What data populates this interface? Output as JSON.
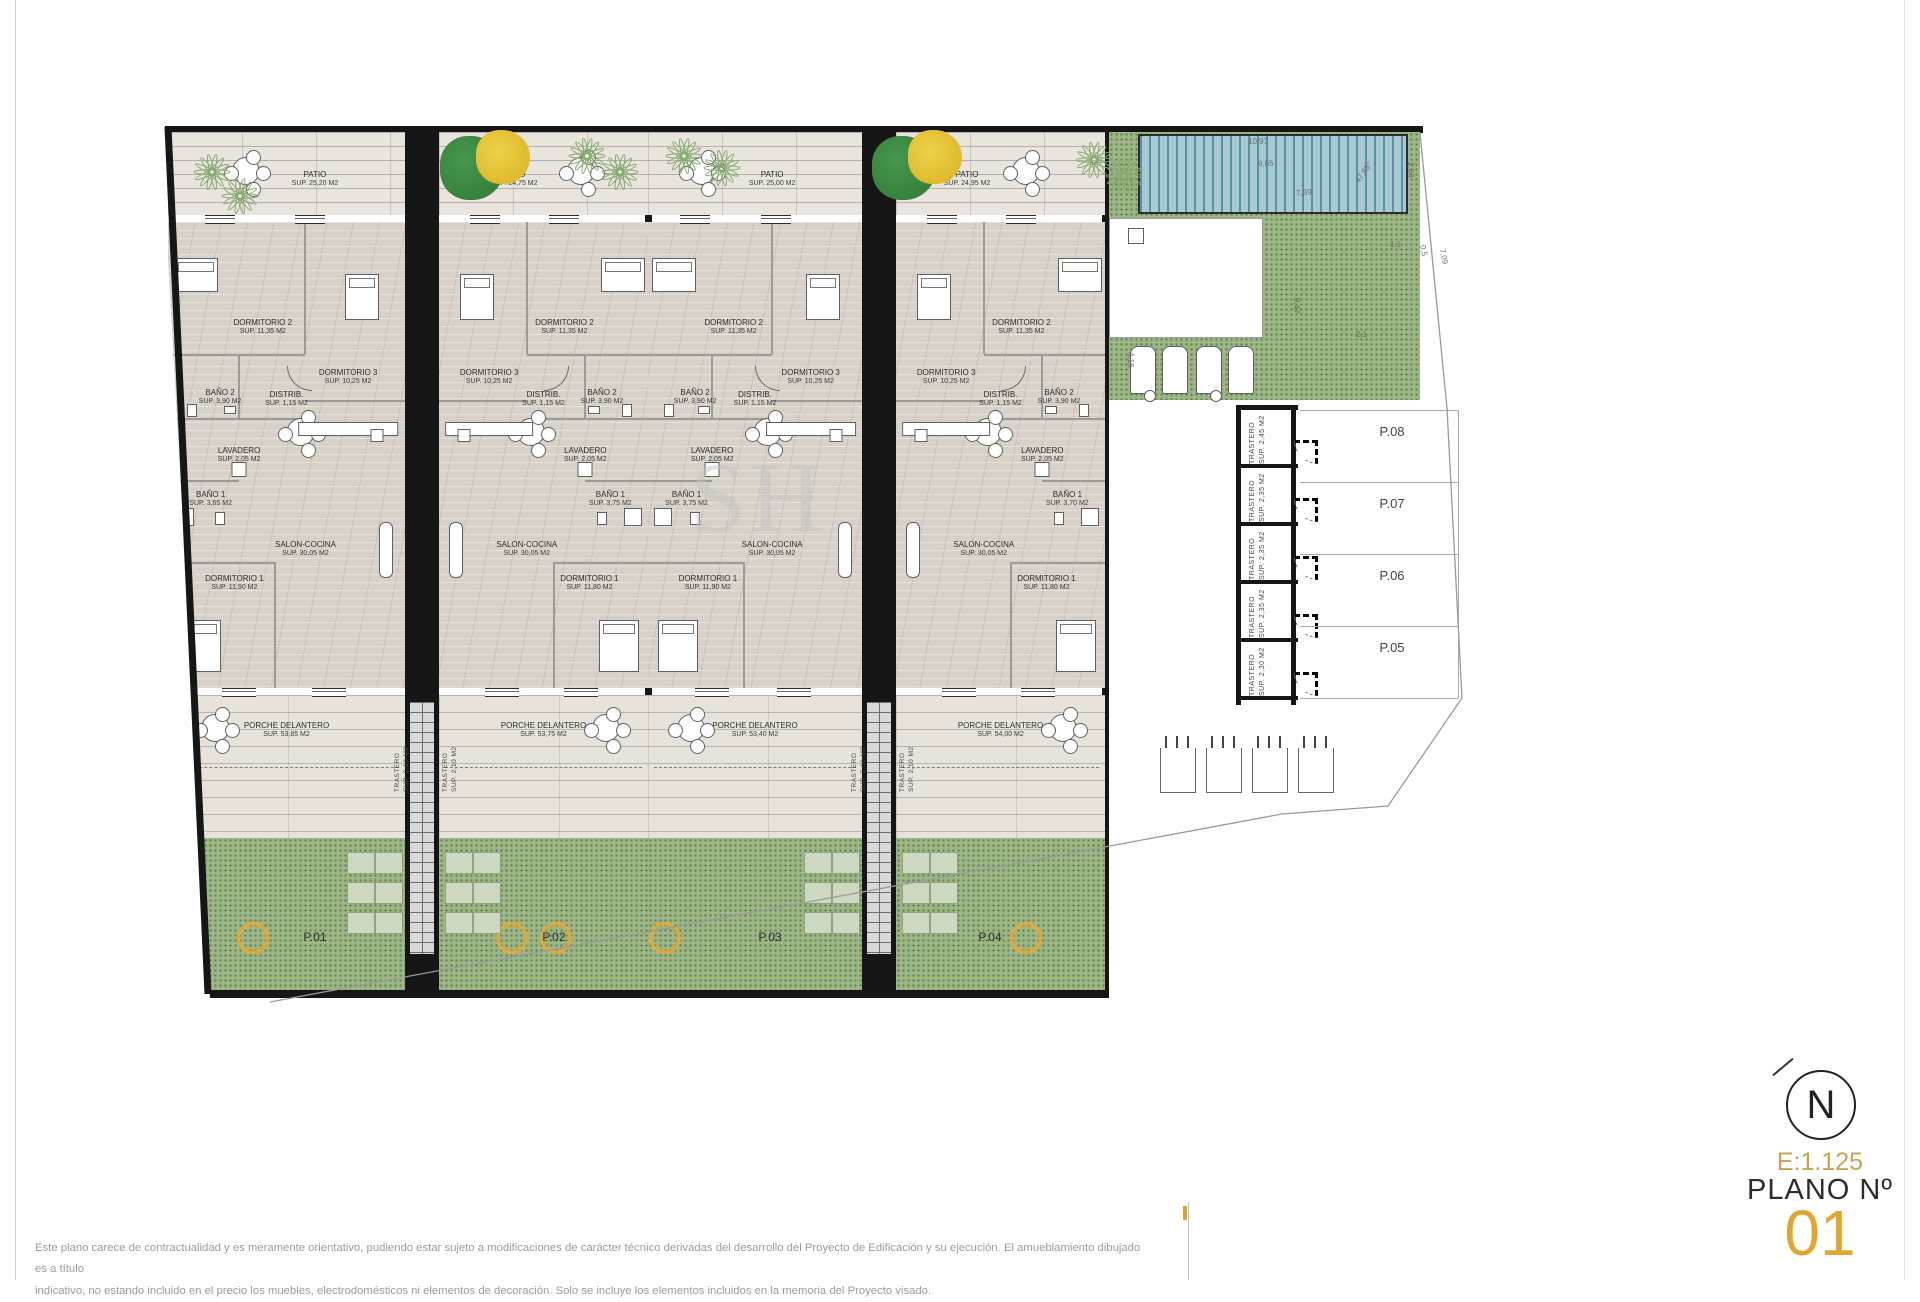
{
  "page": {
    "disclaimer_line1": "Este plano carece de contractualidad y es meramente orientativo, pudiendo estar sujeto a modificaciones de carácter técnico derivadas del desarrollo del Proyecto de Edificación y su ejecución. El amueblamiento dibujado es a título",
    "disclaimer_line2": "indicativo, no estando incluido en el precio los muebles, electrodomésticos ni elementos de decoración. Solo se incluye los elementos incluidos en la memoria del Proyecto visado."
  },
  "title_block": {
    "north": "N",
    "scale": "E:1.125",
    "plan_label": "PLANO Nº",
    "plan_number": "01",
    "number_color": "#E2A62F",
    "scale_color": "#C8A44C",
    "accent_gold": "#D9A62E"
  },
  "watermark": "SH",
  "plan": {
    "units": [
      {
        "plot": "P.01",
        "mirrored": false,
        "patio": {
          "name": "PATIO",
          "sup": "SUP. 25,20 M2"
        },
        "porche": {
          "name": "PORCHE DELANTERO",
          "sup": "SUP. 53,85 M2"
        },
        "rooms": {
          "dormitorio2": {
            "name": "DORMITORIO 2",
            "sup": "SUP. 11,35 M2"
          },
          "dormitorio3": {
            "name": "DORMITORIO 3",
            "sup": "SUP. 10,25 M2"
          },
          "bano2": {
            "name": "BAÑO 2",
            "sup": "SUP. 3,90 M2"
          },
          "distrib": {
            "name": "DISTRIB.",
            "sup": "SUP. 1,15 M2"
          },
          "lavadero": {
            "name": "LAVADERO",
            "sup": "SUP. 2,05 M2"
          },
          "bano1": {
            "name": "BAÑO 1",
            "sup": "SUP. 3,65 M2"
          },
          "salon": {
            "name": "SALON-COCINA",
            "sup": "SUP. 30,05 M2"
          },
          "dormitorio1": {
            "name": "DORMITORIO 1",
            "sup": "SUP. 11,90 M2"
          }
        }
      },
      {
        "plot": "P.02",
        "mirrored": true,
        "patio": {
          "name": "PATIO",
          "sup": "SUP. 24,75 M2"
        },
        "porche": {
          "name": "PORCHE DELANTERO",
          "sup": "SUP. 53,75 M2"
        },
        "rooms": {
          "dormitorio2": {
            "name": "DORMITORIO 2",
            "sup": "SUP. 11,35 M2"
          },
          "dormitorio3": {
            "name": "DORMITORIO 3",
            "sup": "SUP. 10,25 M2"
          },
          "bano2": {
            "name": "BAÑO 2",
            "sup": "SUP. 3,90 M2"
          },
          "distrib": {
            "name": "DISTRIB.",
            "sup": "SUP. 1,15 M2"
          },
          "lavadero": {
            "name": "LAVADERO",
            "sup": "SUP. 2,05 M2"
          },
          "bano1": {
            "name": "BAÑO 1",
            "sup": "SUP. 3,75 M2"
          },
          "salon": {
            "name": "SALON-COCINA",
            "sup": "SUP. 30,05 M2"
          },
          "dormitorio1": {
            "name": "DORMITORIO 1",
            "sup": "SUP. 11,80 M2"
          }
        }
      },
      {
        "plot": "P.03",
        "mirrored": false,
        "patio": {
          "name": "PATIO",
          "sup": "SUP. 25,00 M2"
        },
        "porche": {
          "name": "PORCHE DELANTERO",
          "sup": "SUP. 53,40 M2"
        },
        "rooms": {
          "dormitorio2": {
            "name": "DORMITORIO 2",
            "sup": "SUP. 11,35 M2"
          },
          "dormitorio3": {
            "name": "DORMITORIO 3",
            "sup": "SUP. 10,25 M2"
          },
          "bano2": {
            "name": "BAÑO 2",
            "sup": "SUP. 3,90 M2"
          },
          "distrib": {
            "name": "DISTRIB.",
            "sup": "SUP. 1,15 M2"
          },
          "lavadero": {
            "name": "LAVADERO",
            "sup": "SUP. 2,05 M2"
          },
          "bano1": {
            "name": "BAÑO 1",
            "sup": "SUP. 3,75 M2"
          },
          "salon": {
            "name": "SALON-COCINA",
            "sup": "SUP. 30,05 M2"
          },
          "dormitorio1": {
            "name": "DORMITORIO 1",
            "sup": "SUP. 11,90 M2"
          }
        }
      },
      {
        "plot": "P.04",
        "mirrored": true,
        "patio": {
          "name": "PATIO",
          "sup": "SUP. 24,95 M2"
        },
        "porche": {
          "name": "PORCHE DELANTERO",
          "sup": "SUP. 54,00 M2"
        },
        "rooms": {
          "dormitorio2": {
            "name": "DORMITORIO 2",
            "sup": "SUP. 11,35 M2"
          },
          "dormitorio3": {
            "name": "DORMITORIO 3",
            "sup": "SUP. 10,25 M2"
          },
          "bano2": {
            "name": "BAÑO 2",
            "sup": "SUP. 3,90 M2"
          },
          "distrib": {
            "name": "DISTRIB.",
            "sup": "SUP. 1,15 M2"
          },
          "lavadero": {
            "name": "LAVADERO",
            "sup": "SUP. 2,05 M2"
          },
          "bano1": {
            "name": "BAÑO 1",
            "sup": "SUP. 3,70 M2"
          },
          "salon": {
            "name": "SALON-COCINA",
            "sup": "SUP. 30,05 M2"
          },
          "dormitorio1": {
            "name": "DORMITORIO 1",
            "sup": "SUP. 11,80 M2"
          }
        }
      }
    ],
    "shaft_trastero": {
      "name": "TRASTERO",
      "sup": "SUP. 2,10 M2"
    },
    "right_wing": {
      "trasteros": [
        {
          "name": "TRASTERO",
          "sup": "SUP. 2,45 M2"
        },
        {
          "name": "TRASTERO",
          "sup": "SUP. 2,35 M2"
        },
        {
          "name": "TRASTERO",
          "sup": "SUP. 2,35 M2"
        },
        {
          "name": "TRASTERO",
          "sup": "SUP. 2,35 M2"
        },
        {
          "name": "TRASTERO",
          "sup": "SUP. 2,30 M2"
        }
      ],
      "parking": [
        "P.08",
        "P.07",
        "P.06",
        "P.05"
      ],
      "dimensions": [
        "10,97",
        "9,65",
        "7,39",
        "2,64",
        "47,88°",
        "1,1",
        "0,5",
        "7,09",
        "9,47",
        "2,1",
        "4,16"
      ]
    }
  }
}
